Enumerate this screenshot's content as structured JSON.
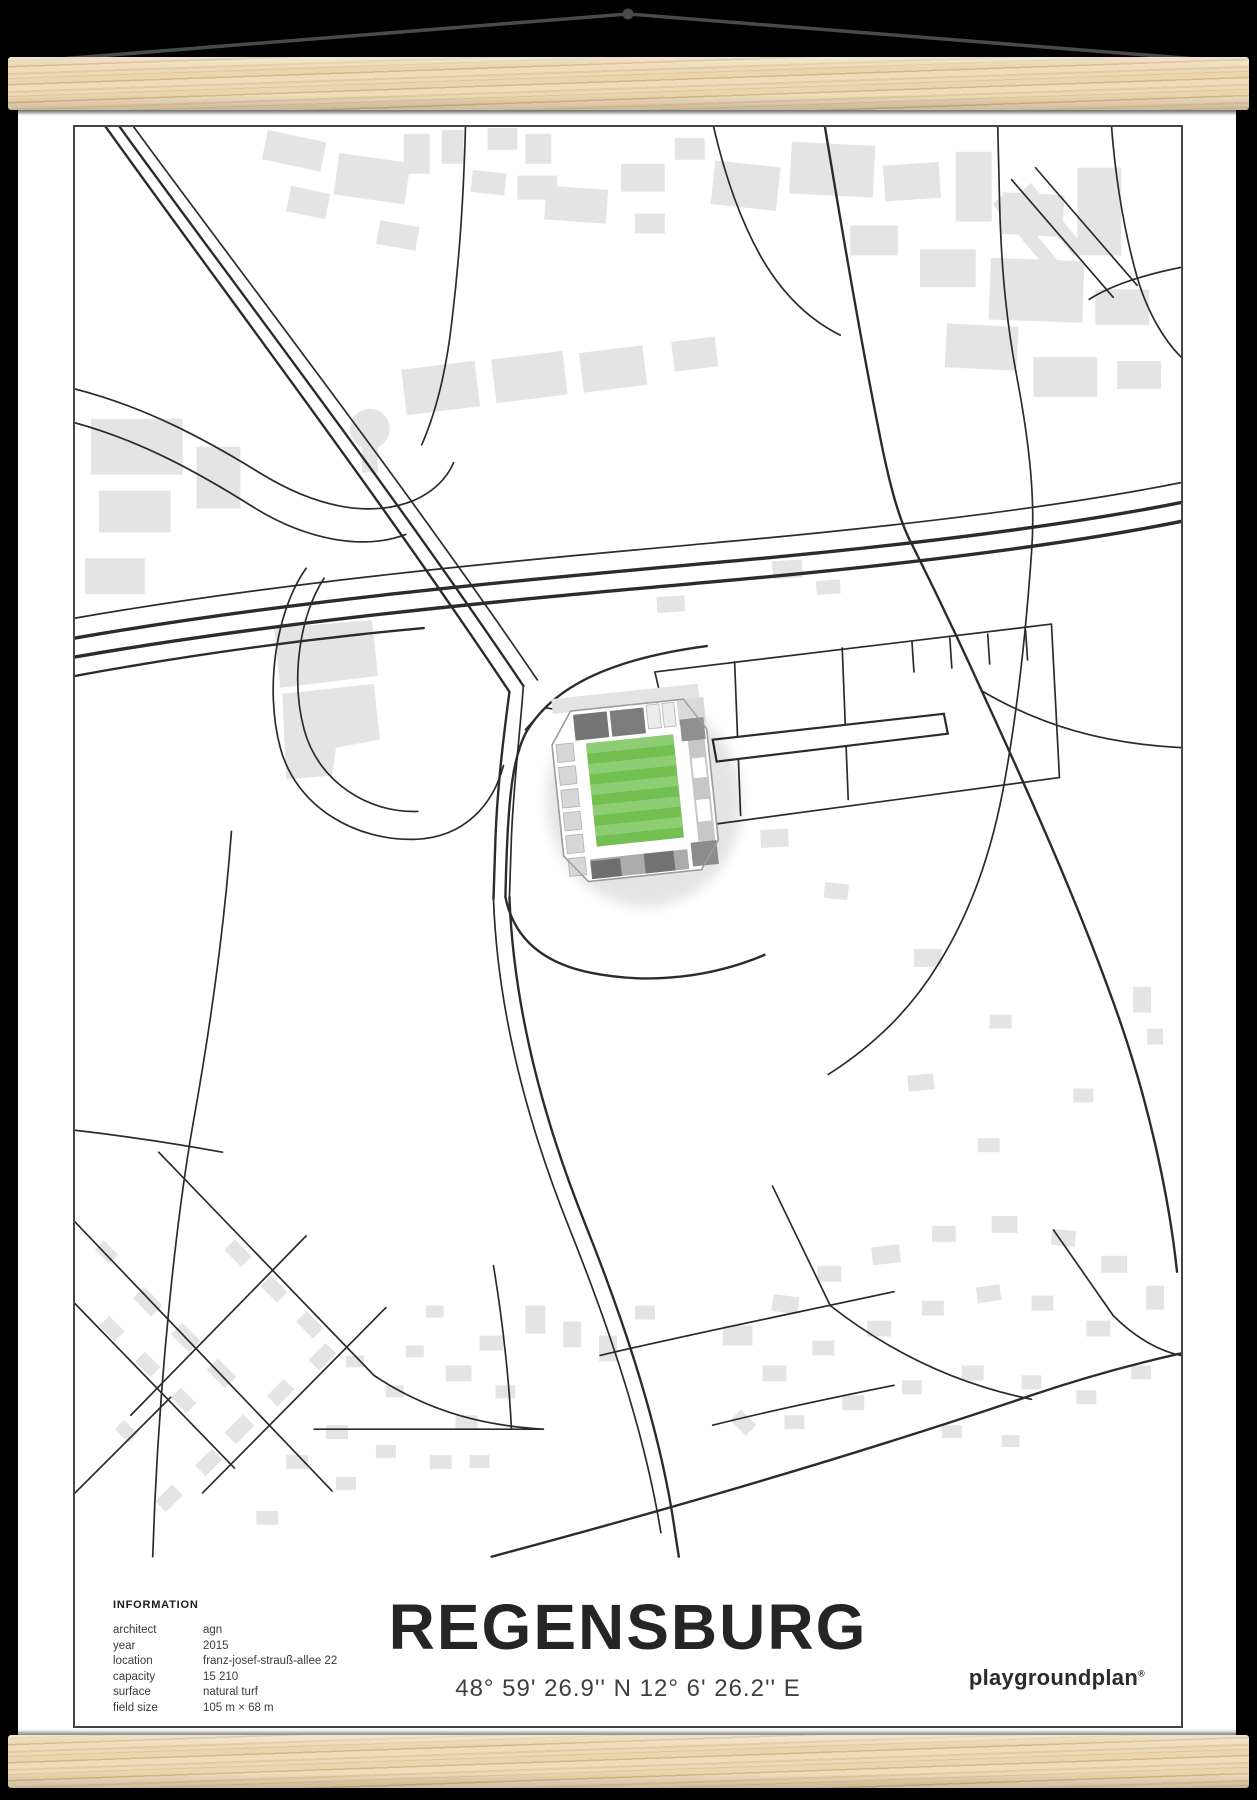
{
  "colors": {
    "background": "#000000",
    "wood_base": "#e8d4ae",
    "string": "#4a4a4a",
    "frame_border": "#454545",
    "road": "#2b2b2b",
    "building": "#e4e4e4",
    "pitch_dark": "#74bf52",
    "pitch_light": "#8ecd74"
  },
  "footer": {
    "information": {
      "title": "INFORMATION",
      "rows": [
        {
          "label": "architect",
          "value": "agn"
        },
        {
          "label": "year",
          "value": "2015"
        },
        {
          "label": "location",
          "value": "franz-josef-strauß-allee 22"
        },
        {
          "label": "capacity",
          "value": "15 210"
        },
        {
          "label": "surface",
          "value": "natural turf"
        },
        {
          "label": "field size",
          "value": "105 m × 68 m"
        }
      ]
    },
    "title": "REGENSBURG",
    "coordinates": "48° 59' 26.9'' N  12° 6' 26.2'' E",
    "brand": "playgroundplan",
    "brand_mark": "®"
  }
}
